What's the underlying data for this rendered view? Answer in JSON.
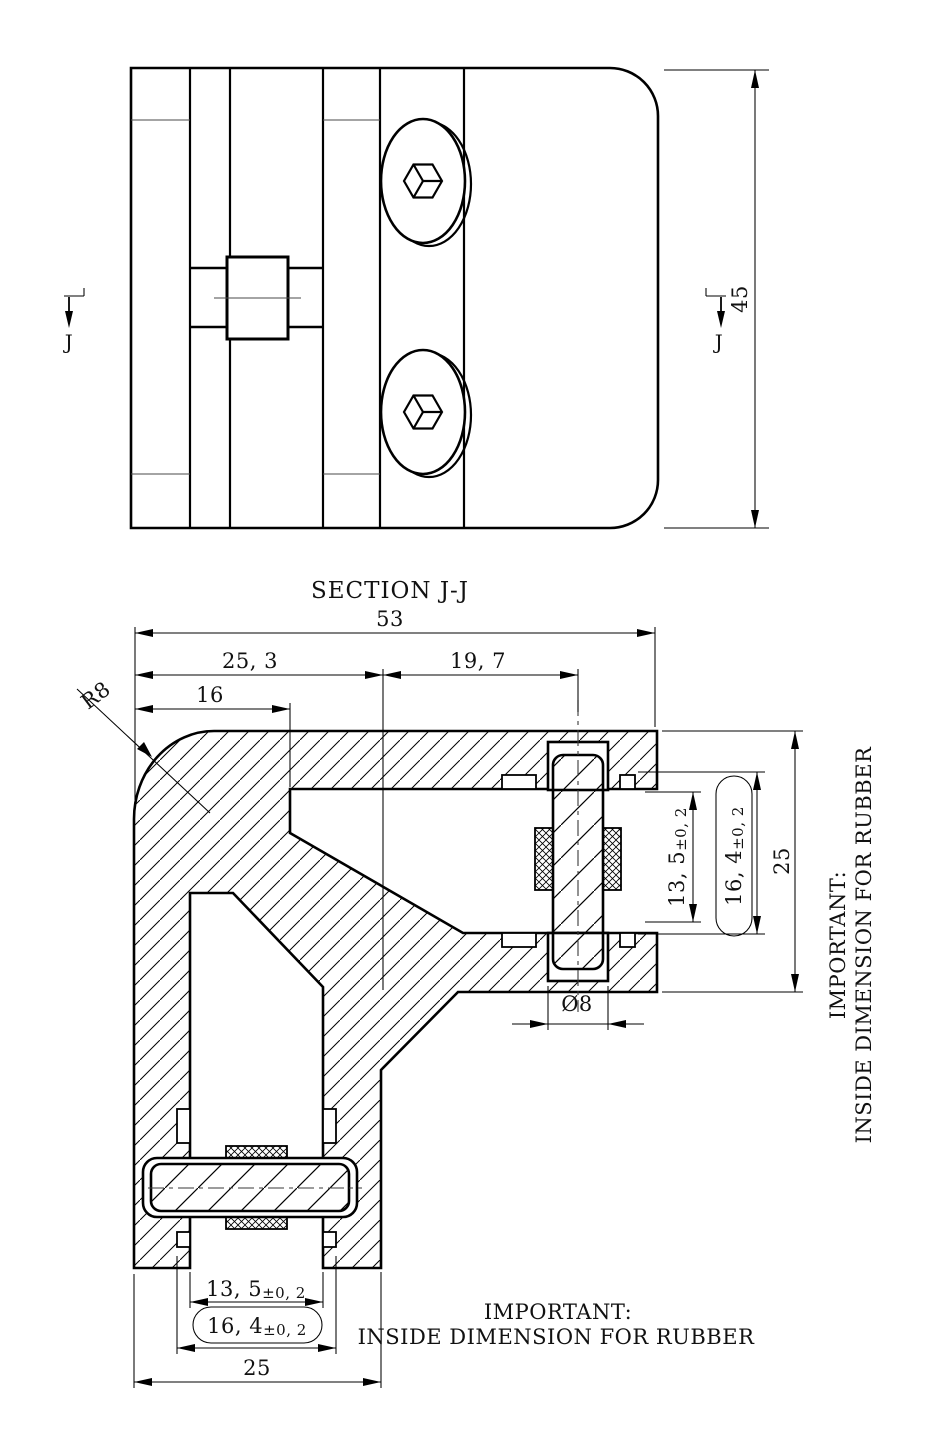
{
  "drawing": {
    "section_label": "J",
    "top_view": {
      "height_dim": "45"
    },
    "section_view": {
      "title": "SECTION J-J",
      "dims": {
        "overall_width": "53",
        "left_segment": "25, 3",
        "right_segment": "19, 7",
        "corner_offset": "16",
        "corner_radius": "R8",
        "pin_diameter": "Ø8",
        "arm_depth": "25",
        "rubber_gap_main": "13, 5",
        "rubber_gap_tol": "±0, 2",
        "rubber_slot_main": "16, 4",
        "rubber_slot_tol": "±0, 2"
      },
      "note": {
        "line1": "IMPORTANT:",
        "line2": "INSIDE DIMENSION FOR RUBBER"
      }
    }
  }
}
